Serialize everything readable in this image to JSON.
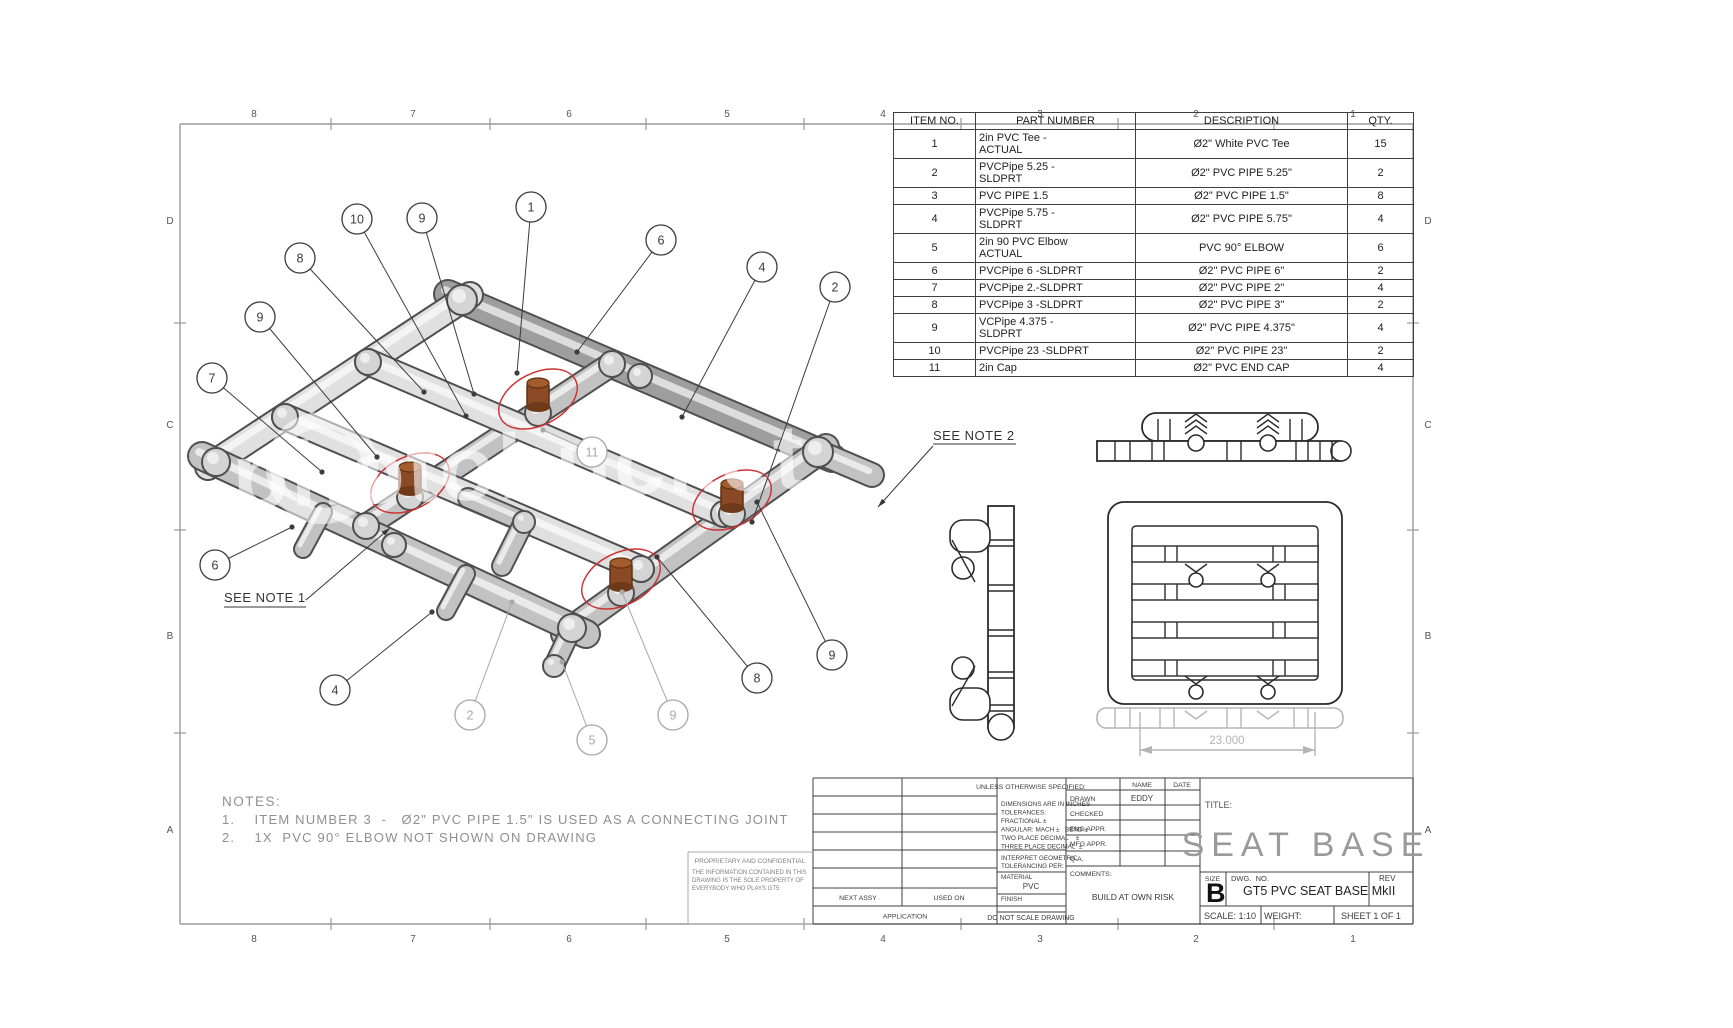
{
  "sheet": {
    "zones_top": [
      "8",
      "7",
      "6",
      "5",
      "4",
      "3",
      "2",
      "1"
    ],
    "zones_side": [
      "D",
      "C",
      "B",
      "A"
    ],
    "watermark": "photobucket"
  },
  "bom": {
    "headers": [
      "ITEM NO.",
      "PART NUMBER",
      "DESCRIPTION",
      "QTY."
    ],
    "rows": [
      {
        "item": "1",
        "part": "2in PVC Tee -\nACTUAL",
        "desc": "Ø2\" White PVC Tee",
        "qty": "15"
      },
      {
        "item": "2",
        "part": "PVCPipe 5.25 -\nSLDPRT",
        "desc": "Ø2\" PVC PIPE 5.25\"",
        "qty": "2"
      },
      {
        "item": "3",
        "part": " PVC PIPE 1.5",
        "desc": "Ø2\" PVC PIPE 1.5\"",
        "qty": "8"
      },
      {
        "item": "4",
        "part": "PVCPipe 5.75 -\nSLDPRT",
        "desc": "Ø2\" PVC PIPE 5.75\"",
        "qty": "4"
      },
      {
        "item": "5",
        "part": "2in 90 PVC Elbow\nACTUAL",
        "desc": "PVC 90° ELBOW",
        "qty": "6"
      },
      {
        "item": "6",
        "part": "PVCPipe 6 -SLDPRT",
        "desc": "Ø2\" PVC PIPE 6\"",
        "qty": "2"
      },
      {
        "item": "7",
        "part": "PVCPipe 2.-SLDPRT",
        "desc": "Ø2\" PVC PIPE 2\"",
        "qty": "4"
      },
      {
        "item": "8",
        "part": "PVCPipe 3 -SLDPRT",
        "desc": "Ø2\" PVC PIPE 3\"",
        "qty": "2"
      },
      {
        "item": "9",
        "part": "VCPipe 4.375 -\nSLDPRT",
        "desc": "Ø2\" PVC PIPE 4.375\"",
        "qty": "4"
      },
      {
        "item": "10",
        "part": "PVCPipe 23 -SLDPRT",
        "desc": "Ø2\" PVC PIPE 23\"",
        "qty": "2"
      },
      {
        "item": "11",
        "part": "2in Cap",
        "desc": "Ø2\" PVC END CAP",
        "qty": "4"
      }
    ]
  },
  "notes": {
    "heading": "NOTES:",
    "items": [
      "1.    ITEM NUMBER 3  -   Ø2\" PVC PIPE 1.5\" IS USED AS A CONNECTING JOINT",
      "2.    1X  PVC 90° ELBOW NOT SHOWN ON DRAWING"
    ]
  },
  "see_notes": {
    "note1": "SEE NOTE 1",
    "note2": "SEE NOTE 2"
  },
  "balloons": [
    "8",
    "10",
    "9",
    "1",
    "6",
    "4",
    "2",
    "9",
    "7",
    "11",
    "6",
    "4",
    "2",
    "5",
    "9",
    "8",
    "9"
  ],
  "dimension": {
    "value": "23.000"
  },
  "title_block": {
    "unless": "UNLESS OTHERWISE SPECIFIED:",
    "tol_lines": [
      "DIMENSIONS ARE IN INCHES",
      "TOLERANCES:",
      "FRACTIONAL ±",
      "ANGULAR: MACH ±   BEND ±",
      "TWO PLACE DECIMAL    ±",
      "THREE PLACE DECIMAL  ±"
    ],
    "interpret_1": "INTERPRET GEOMETRIC",
    "interpret_2": "TOLERANCING PER:",
    "material_label": "MATERIAL",
    "material_value": "PVC",
    "finish_label": "FINISH",
    "do_not_scale": "DO NOT SCALE DRAWING",
    "next_assy": "NEXT ASSY",
    "used_on": "USED ON",
    "application": "APPLICATION",
    "name_header": "NAME",
    "date_header": "DATE",
    "approval_rows": [
      "DRAWN",
      "CHECKED",
      "ENG APPR.",
      "MFG APPR.",
      "Q.A."
    ],
    "drawn_name": "EDDY",
    "comments_label": "COMMENTS:",
    "comments_value": "BUILD AT OWN RISK",
    "title_label": "TITLE:",
    "title": "SEAT BASE",
    "size_label": "SIZE",
    "size": "B",
    "dwg_label": "DWG.  NO.",
    "dwg_no": "GT5 PVC SEAT BASE MkII",
    "rev_label": "REV",
    "scale": "SCALE: 1:10",
    "weight": "WEIGHT:",
    "sheet": "SHEET 1 OF 1"
  },
  "proprietary": {
    "heading": "PROPRIETARY AND CONFIDENTIAL",
    "lines": [
      "THE INFORMATION CONTAINED IN THIS",
      "DRAWING IS THE SOLE PROPERTY OF",
      "EVERYBODY WHO PLAYS GT5"
    ]
  },
  "colors": {
    "highlight_red": "#cc3333",
    "cap_brown": "#8a4a26",
    "cap_brown_dark": "#6e3a1a",
    "pipe_light": "#e0e0e0",
    "pipe_mid": "#c2c2c2",
    "pipe_dark": "#9e9e9e",
    "outline": "#4f4f4f",
    "frame_gray": "#9a9a9a",
    "ghost_gray": "#b5b5b5",
    "text_dark": "#2b2b2b",
    "notes_gray": "#8f8f8f",
    "title_gray": "#9a9a9a"
  }
}
